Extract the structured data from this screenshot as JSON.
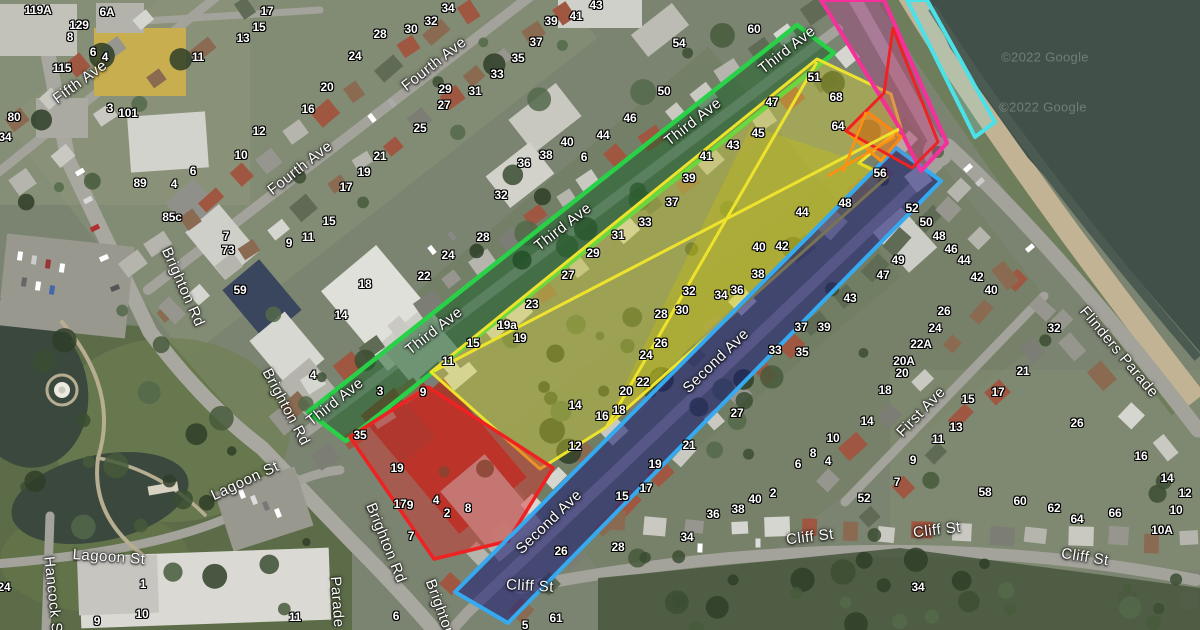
{
  "map": {
    "attribution": "©2022 Google",
    "watermarks": [
      [
        "©2022 Google",
        1045,
        57
      ],
      [
        "©2022 Google",
        1043,
        107
      ]
    ],
    "colors": {
      "green_band": "#28d148",
      "yellow_zone": "#eee32c",
      "blue_border": "#35aaf0",
      "navy_fill": "rgba(24,24,118,0.55)",
      "red_zone": "#ee2222",
      "orange_zone": "#ff9010",
      "pink_band": "#f5309b",
      "cyan_strip": "#4ae2e8"
    },
    "zones": [
      {
        "name": "third-ave-green-band",
        "stroke": "#28d148",
        "w": 4.5,
        "fill": "rgba(25,95,40,0.52)",
        "pts": [
          [
            797,
            25
          ],
          [
            834,
            53
          ],
          [
            346,
            441
          ],
          [
            308,
            412
          ]
        ]
      },
      {
        "name": "yellow-precinct",
        "stroke": "#eee32c",
        "w": 3,
        "fill": "rgba(232,225,45,0.35)",
        "pts": [
          [
            817,
            59
          ],
          [
            891,
            94
          ],
          [
            901,
            128
          ],
          [
            859,
            163
          ],
          [
            887,
            177
          ],
          [
            605,
            428
          ],
          [
            540,
            469
          ],
          [
            431,
            372
          ]
        ]
      },
      {
        "name": "yellow-inner-triangle",
        "stroke": "none",
        "w": 0,
        "fill": "rgba(210,200,0,0.30)",
        "pts": [
          [
            751,
            126
          ],
          [
            604,
            428
          ],
          [
            881,
            169
          ]
        ]
      },
      {
        "name": "red-precinct-sw",
        "stroke": "#ee2222",
        "w": 3.5,
        "fill": "rgba(225,35,35,0.42)",
        "pts": [
          [
            428,
            387
          ],
          [
            553,
            468
          ],
          [
            508,
            541
          ],
          [
            434,
            559
          ],
          [
            350,
            437
          ]
        ]
      },
      {
        "name": "second-ave-blue-band",
        "stroke": "#35aaf0",
        "w": 4,
        "fill": "rgba(24,24,118,0.55)",
        "pts": [
          [
            896,
            148
          ],
          [
            941,
            181
          ],
          [
            508,
            623
          ],
          [
            455,
            592
          ]
        ]
      },
      {
        "name": "pink-road-band",
        "stroke": "#f5309b",
        "w": 4,
        "fill": "rgba(185,40,140,0.32)",
        "pts": [
          [
            821,
            0
          ],
          [
            884,
            0
          ],
          [
            947,
            143
          ],
          [
            921,
            171
          ],
          [
            899,
            127
          ]
        ]
      },
      {
        "name": "orange-quad",
        "stroke": "#ff9010",
        "w": 3,
        "fill": "rgba(248,150,30,0.5)",
        "pts": [
          [
            866,
            111
          ],
          [
            901,
            137
          ],
          [
            881,
            161
          ],
          [
            846,
            131
          ]
        ]
      },
      {
        "name": "red-outline-ne",
        "stroke": "#ee2222",
        "w": 3,
        "fill": "rgba(240,40,40,0.10)",
        "pts": [
          [
            893,
            28
          ],
          [
            938,
            142
          ],
          [
            912,
            168
          ],
          [
            846,
            131
          ],
          [
            884,
            93
          ]
        ]
      },
      {
        "name": "cyan-foreshore-strip",
        "stroke": "#4ae2e8",
        "w": 4,
        "fill": "rgba(140,240,240,0.22)",
        "pts": [
          [
            907,
            0
          ],
          [
            927,
            0
          ],
          [
            995,
            122
          ],
          [
            975,
            137
          ]
        ]
      }
    ],
    "zone_lines": [
      {
        "name": "yellow-cross-1",
        "stroke": "#eee32c",
        "w": 3,
        "pts": [
          [
            434,
            371
          ],
          [
            899,
            129
          ]
        ]
      },
      {
        "name": "yellow-cross-2",
        "stroke": "#eee32c",
        "w": 3,
        "pts": [
          [
            607,
            426
          ],
          [
            817,
            62
          ]
        ]
      },
      {
        "name": "orange-line-1",
        "stroke": "#ff9010",
        "w": 2.5,
        "pts": [
          [
            895,
            137
          ],
          [
            828,
            176
          ]
        ]
      },
      {
        "name": "orange-line-2",
        "stroke": "#ff9010",
        "w": 2.5,
        "pts": [
          [
            866,
            112
          ],
          [
            843,
            172
          ]
        ]
      }
    ],
    "street_labels": [
      [
        "Fifth Ave",
        80,
        82,
        -36
      ],
      [
        "Fourth Ave",
        434,
        64,
        -38
      ],
      [
        "Fourth Ave",
        300,
        168,
        -38
      ],
      [
        "Third Ave",
        787,
        50,
        -38
      ],
      [
        "Third Ave",
        693,
        122,
        -38
      ],
      [
        "Third Ave",
        563,
        227,
        -38
      ],
      [
        "Third Ave",
        434,
        331,
        -38
      ],
      [
        "Third Ave",
        335,
        402,
        -38
      ],
      [
        "Second Ave",
        716,
        361,
        -44
      ],
      [
        "Second Ave",
        549,
        522,
        -44
      ],
      [
        "First Ave",
        921,
        412,
        -46
      ],
      [
        "Brighton Rd",
        183,
        287,
        66
      ],
      [
        "Brighton Rd",
        286,
        407,
        62
      ],
      [
        "Brighton Rd",
        386,
        543,
        68
      ],
      [
        "Brighton",
        440,
        608,
        70
      ],
      [
        "Parade",
        337,
        602,
        86
      ],
      [
        "Lagoon St",
        109,
        557,
        4
      ],
      [
        "Lagoon St",
        245,
        481,
        -25
      ],
      [
        "Hancock St",
        53,
        597,
        84
      ],
      [
        "Cliff St",
        530,
        586,
        3
      ],
      [
        "Cliff St",
        810,
        537,
        -7
      ],
      [
        "Cliff St",
        937,
        530,
        -7
      ],
      [
        "Cliff St",
        1085,
        557,
        9
      ],
      [
        "Flinders Parade",
        1119,
        352,
        50
      ]
    ],
    "house_numbers": [
      [
        "119A",
        38,
        10
      ],
      [
        "6A",
        107,
        12
      ],
      [
        "129",
        79,
        25
      ],
      [
        "8",
        70,
        37
      ],
      [
        "6",
        93,
        52
      ],
      [
        "4",
        105,
        57
      ],
      [
        "115",
        62,
        68
      ],
      [
        "3",
        110,
        108
      ],
      [
        "101",
        128,
        113
      ],
      [
        "80",
        14,
        117
      ],
      [
        "34",
        5,
        137
      ],
      [
        "11",
        198,
        57
      ],
      [
        "13",
        243,
        38
      ],
      [
        "15",
        259,
        27
      ],
      [
        "17",
        267,
        11
      ],
      [
        "12",
        259,
        131
      ],
      [
        "10",
        241,
        155
      ],
      [
        "16",
        308,
        109
      ],
      [
        "6",
        193,
        171
      ],
      [
        "34",
        448,
        8
      ],
      [
        "32",
        431,
        21
      ],
      [
        "30",
        411,
        29
      ],
      [
        "28",
        380,
        34
      ],
      [
        "24",
        355,
        56
      ],
      [
        "20",
        327,
        87
      ],
      [
        "43",
        596,
        5
      ],
      [
        "41",
        576,
        16
      ],
      [
        "39",
        551,
        21
      ],
      [
        "37",
        536,
        42
      ],
      [
        "35",
        518,
        58
      ],
      [
        "33",
        497,
        74
      ],
      [
        "31",
        475,
        91
      ],
      [
        "29",
        445,
        89
      ],
      [
        "27",
        444,
        105
      ],
      [
        "25",
        420,
        128
      ],
      [
        "21",
        380,
        156
      ],
      [
        "19",
        364,
        172
      ],
      [
        "17",
        346,
        187
      ],
      [
        "15",
        329,
        221
      ],
      [
        "11",
        308,
        237
      ],
      [
        "9",
        289,
        243
      ],
      [
        "7",
        226,
        236
      ],
      [
        "73",
        228,
        250
      ],
      [
        "18",
        365,
        284
      ],
      [
        "14",
        341,
        315
      ],
      [
        "22",
        424,
        276
      ],
      [
        "24",
        448,
        255
      ],
      [
        "28",
        483,
        237
      ],
      [
        "32",
        501,
        195
      ],
      [
        "36",
        524,
        163
      ],
      [
        "38",
        546,
        155
      ],
      [
        "40",
        567,
        142
      ],
      [
        "6",
        584,
        157
      ],
      [
        "44",
        603,
        135
      ],
      [
        "46",
        630,
        118
      ],
      [
        "50",
        664,
        91
      ],
      [
        "54",
        679,
        43
      ],
      [
        "60",
        754,
        29
      ],
      [
        "89",
        140,
        183
      ],
      [
        "4",
        174,
        184
      ],
      [
        "85c",
        172,
        217
      ],
      [
        "59",
        240,
        290
      ],
      [
        "4",
        313,
        375
      ],
      [
        "3",
        380,
        391
      ],
      [
        "9",
        423,
        392
      ],
      [
        "19a",
        507,
        325
      ],
      [
        "19",
        520,
        338
      ],
      [
        "15",
        473,
        343
      ],
      [
        "11",
        448,
        361
      ],
      [
        "23",
        532,
        304
      ],
      [
        "27",
        568,
        275
      ],
      [
        "29",
        593,
        253
      ],
      [
        "31",
        618,
        235
      ],
      [
        "33",
        645,
        222
      ],
      [
        "37",
        672,
        202
      ],
      [
        "39",
        689,
        178
      ],
      [
        "41",
        706,
        156
      ],
      [
        "43",
        733,
        145
      ],
      [
        "45",
        758,
        133
      ],
      [
        "47",
        772,
        102
      ],
      [
        "51",
        814,
        77
      ],
      [
        "68",
        836,
        97
      ],
      [
        "64",
        838,
        126
      ],
      [
        "56",
        880,
        173
      ],
      [
        "48",
        845,
        203
      ],
      [
        "44",
        802,
        212
      ],
      [
        "42",
        782,
        246
      ],
      [
        "40",
        759,
        247
      ],
      [
        "38",
        758,
        274
      ],
      [
        "36",
        737,
        290
      ],
      [
        "34",
        721,
        295
      ],
      [
        "32",
        689,
        291
      ],
      [
        "30",
        682,
        310
      ],
      [
        "28",
        661,
        314
      ],
      [
        "26",
        661,
        343
      ],
      [
        "24",
        646,
        355
      ],
      [
        "22",
        643,
        382
      ],
      [
        "20",
        626,
        391
      ],
      [
        "18",
        619,
        410
      ],
      [
        "16",
        602,
        416
      ],
      [
        "14",
        575,
        405
      ],
      [
        "12",
        575,
        446
      ],
      [
        "37",
        801,
        327
      ],
      [
        "39",
        824,
        327
      ],
      [
        "33",
        775,
        350
      ],
      [
        "35",
        802,
        352
      ],
      [
        "27",
        737,
        413
      ],
      [
        "21",
        689,
        445
      ],
      [
        "19",
        655,
        464
      ],
      [
        "18",
        885,
        390
      ],
      [
        "14",
        867,
        421
      ],
      [
        "10",
        833,
        438
      ],
      [
        "8",
        813,
        453
      ],
      [
        "6",
        798,
        464
      ],
      [
        "4",
        828,
        461
      ],
      [
        "52",
        912,
        208
      ],
      [
        "50",
        926,
        222
      ],
      [
        "48",
        939,
        236
      ],
      [
        "46",
        951,
        249
      ],
      [
        "44",
        964,
        260
      ],
      [
        "42",
        977,
        277
      ],
      [
        "40",
        991,
        290
      ],
      [
        "49",
        898,
        260
      ],
      [
        "47",
        883,
        275
      ],
      [
        "43",
        850,
        298
      ],
      [
        "26",
        944,
        311
      ],
      [
        "24",
        935,
        328
      ],
      [
        "22A",
        921,
        344
      ],
      [
        "20A",
        904,
        361
      ],
      [
        "20",
        902,
        373
      ],
      [
        "32",
        1054,
        328
      ],
      [
        "26",
        1077,
        423
      ],
      [
        "16",
        1141,
        456
      ],
      [
        "14",
        1167,
        478
      ],
      [
        "12",
        1185,
        493
      ],
      [
        "10",
        1176,
        510
      ],
      [
        "10A",
        1162,
        530
      ],
      [
        "66",
        1115,
        513
      ],
      [
        "64",
        1077,
        519
      ],
      [
        "62",
        1054,
        508
      ],
      [
        "60",
        1020,
        501
      ],
      [
        "58",
        985,
        492
      ],
      [
        "21",
        1023,
        371
      ],
      [
        "17",
        998,
        392
      ],
      [
        "15",
        968,
        399
      ],
      [
        "13",
        956,
        427
      ],
      [
        "11",
        938,
        439
      ],
      [
        "9",
        913,
        460
      ],
      [
        "7",
        897,
        482
      ],
      [
        "52",
        864,
        498
      ],
      [
        "2",
        773,
        493
      ],
      [
        "40",
        755,
        499
      ],
      [
        "38",
        738,
        509
      ],
      [
        "36",
        713,
        514
      ],
      [
        "34",
        687,
        537
      ],
      [
        "28",
        618,
        547
      ],
      [
        "17",
        646,
        488
      ],
      [
        "15",
        622,
        496
      ],
      [
        "26",
        561,
        551
      ],
      [
        "61",
        556,
        618
      ],
      [
        "5",
        525,
        625
      ],
      [
        "6",
        396,
        616
      ],
      [
        "34",
        918,
        587
      ],
      [
        "35",
        360,
        435
      ],
      [
        "19",
        397,
        468
      ],
      [
        "17",
        400,
        504
      ],
      [
        "9",
        410,
        505
      ],
      [
        "4",
        436,
        500
      ],
      [
        "2",
        447,
        513
      ],
      [
        "8",
        468,
        508
      ],
      [
        "7",
        411,
        536
      ],
      [
        "24",
        4,
        587
      ],
      [
        "1",
        143,
        584
      ],
      [
        "10",
        142,
        614
      ],
      [
        "9",
        97,
        621
      ],
      [
        "11",
        295,
        617
      ]
    ]
  }
}
